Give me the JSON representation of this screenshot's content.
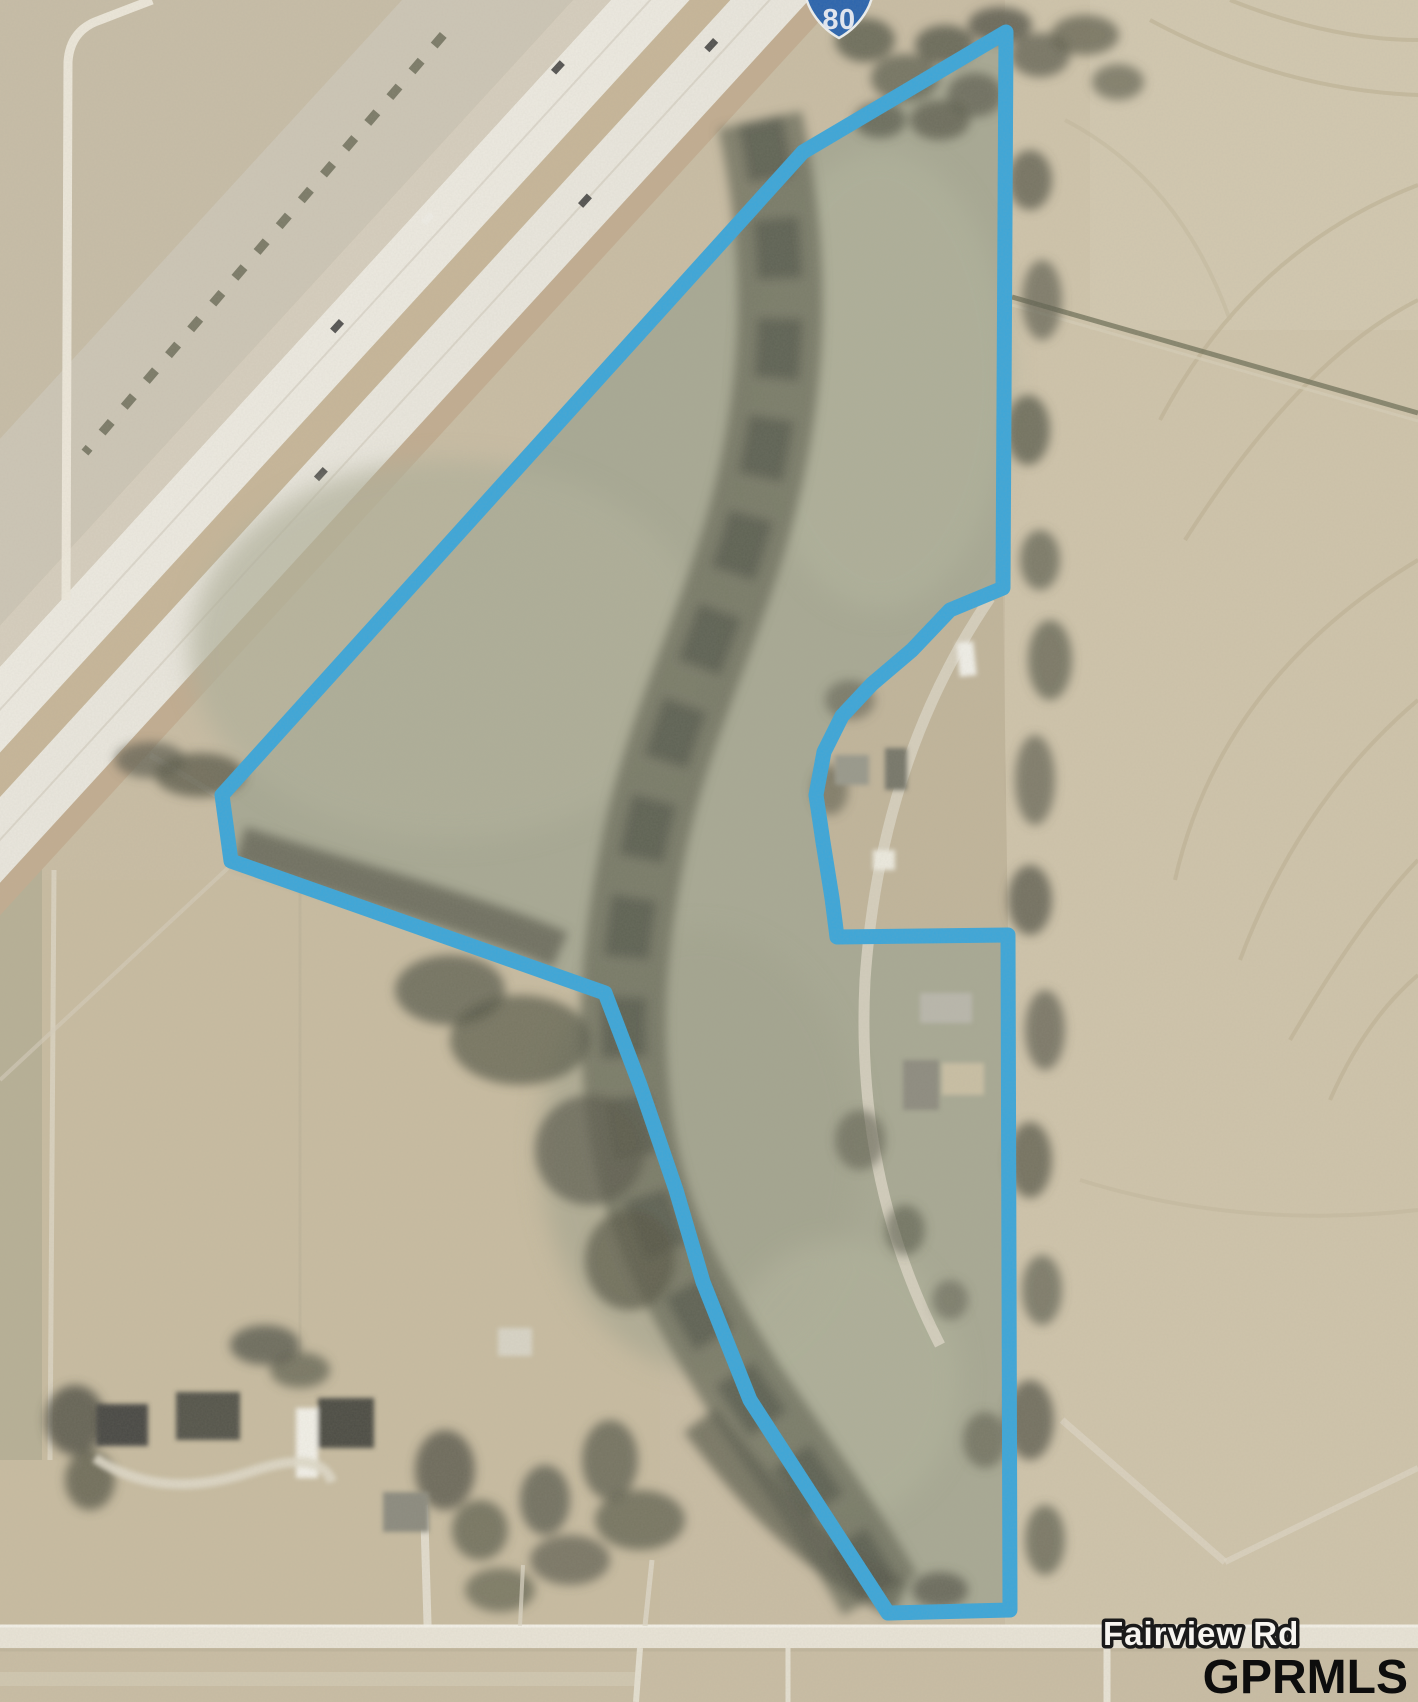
{
  "map": {
    "shield_number": "80",
    "road_label": "Fairview Rd",
    "watermark": "GPRMLS",
    "colors": {
      "boundary": "#3ca6d9",
      "shield": "#2a64ae",
      "road_label_fill": "#f7f5f0",
      "road_label_outline": "#1a1a1a",
      "watermark_color": "#0d0d0d"
    }
  }
}
